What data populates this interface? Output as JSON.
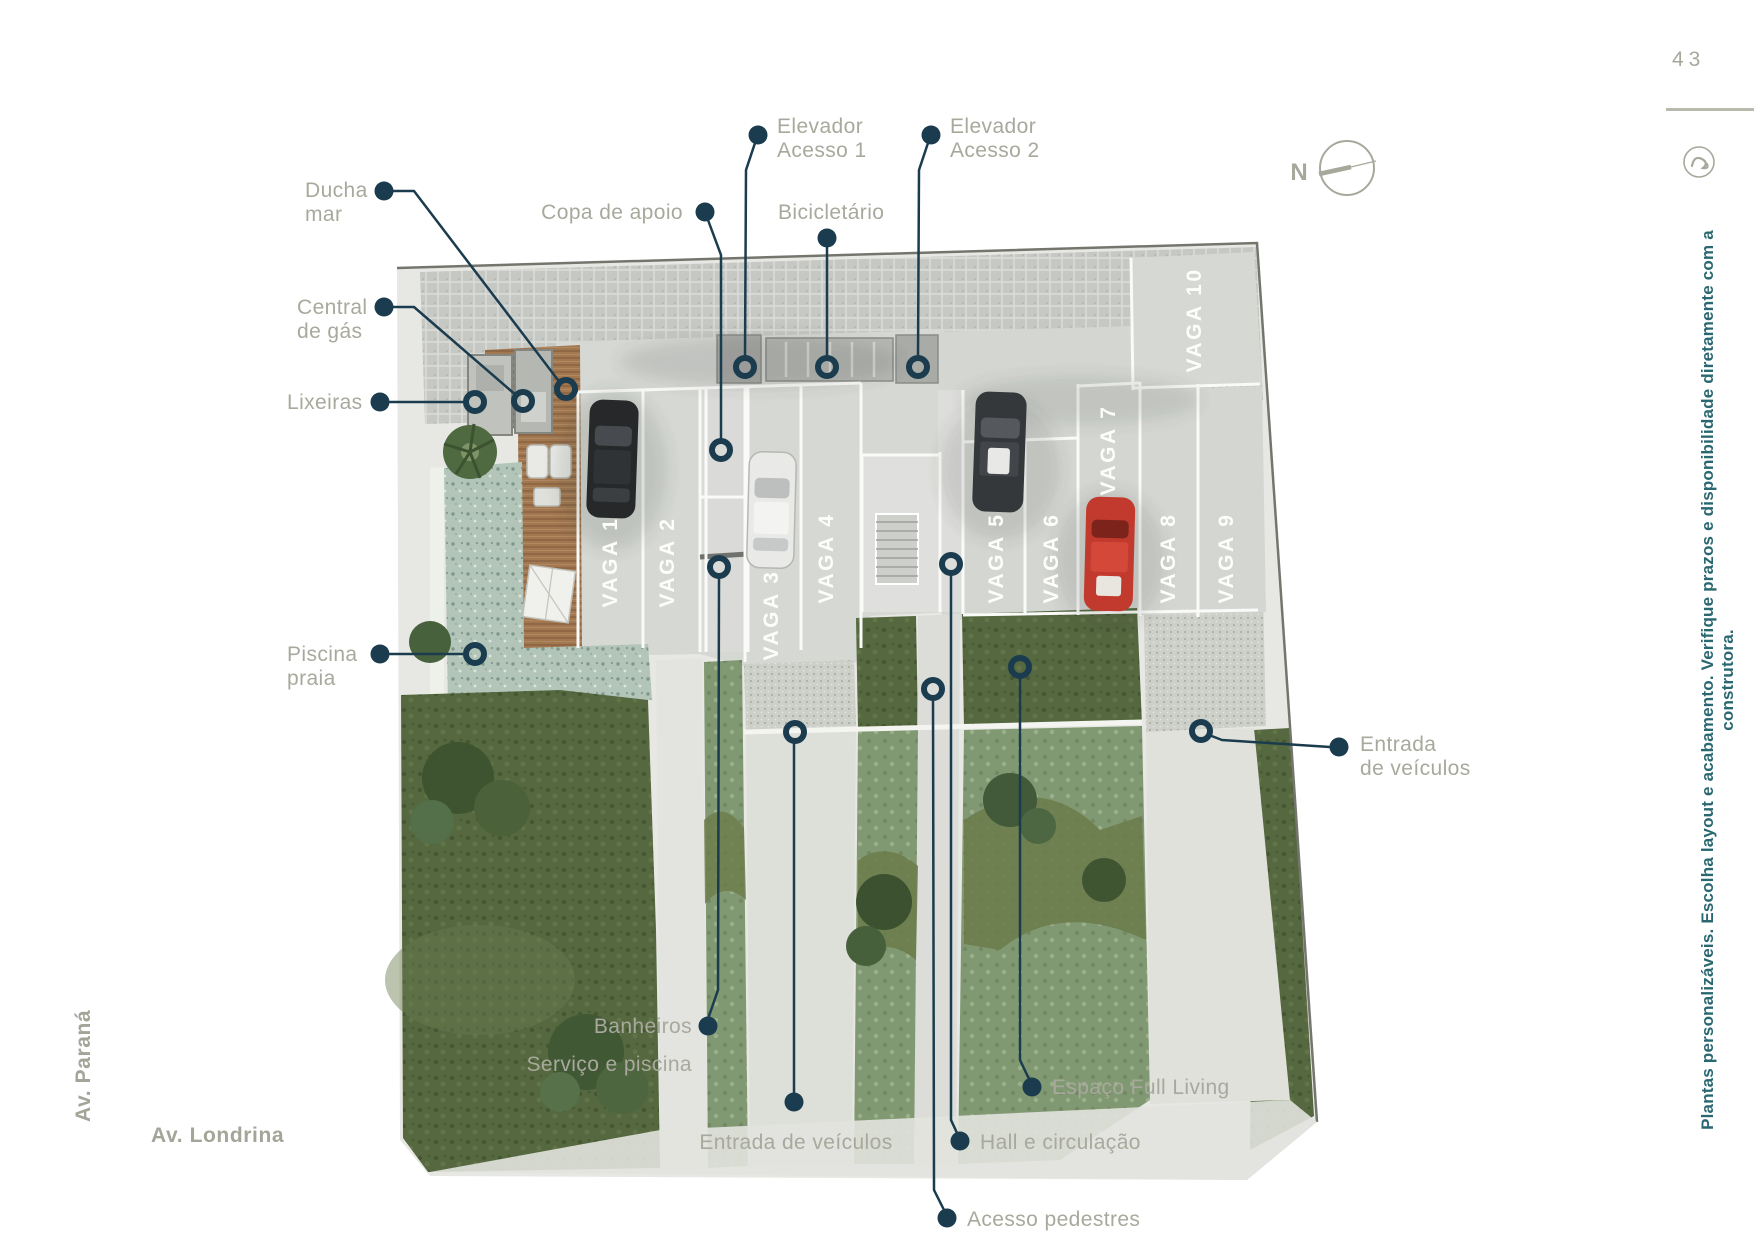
{
  "page_number": "43",
  "compass": {
    "label": "N"
  },
  "side_note": "Plantas personalizáveis. Escolha layout e acabamento. Verifique prazos e disponibilidade diretamente com a construtora.",
  "streets": {
    "left": "Av. Paraná",
    "bottom": "Av. Londrina"
  },
  "callouts": {
    "ducha_mar": "Ducha\nmar",
    "central_gas": "Central\nde gás",
    "lixeiras": "Lixeiras",
    "piscina_praia": "Piscina\npraia",
    "copa_apoio": "Copa de apoio",
    "elevador_acesso_1": "Elevador\nAcesso 1",
    "bicicletario": "Bicicletário",
    "elevador_acesso_2": "Elevador\nAcesso 2",
    "entrada_veiculos_direita": "Entrada\nde veículos",
    "banheiros": "Banheiros\nServiço e piscina",
    "entrada_veiculos_inferior": "Entrada de veículos",
    "hall_circulacao": "Hall e circulação",
    "acesso_pedestres": "Acesso pedestres",
    "espaco_full_living": "Espaço Full Living"
  },
  "plan": {
    "stalls": [
      {
        "label": "VAGA 1"
      },
      {
        "label": "VAGA 2"
      },
      {
        "label": "VAGA 3"
      },
      {
        "label": "VAGA 4"
      },
      {
        "label": "VAGA 5"
      },
      {
        "label": "VAGA 6"
      },
      {
        "label": "VAGA 7"
      },
      {
        "label": "VAGA 8"
      },
      {
        "label": "VAGA 9"
      },
      {
        "label": "VAGA 10"
      }
    ],
    "vehicles": [
      {
        "stall": "VAGA 1",
        "color": "black"
      },
      {
        "stall": "VAGA 3",
        "color": "white"
      },
      {
        "stall": "VAGA 5",
        "color": "dark gray"
      },
      {
        "stall": "VAGA 7",
        "color": "red"
      }
    ]
  },
  "colors": {
    "accent_dark": "#1b3c4e",
    "label_gray": "#a8a99c",
    "note_teal": "#2a6871",
    "grass_dark": "#55683f",
    "grass_light": "#7f9770",
    "pool": "#b3c5b8",
    "deck": "#a27851",
    "slab": "#d6d8d4"
  }
}
